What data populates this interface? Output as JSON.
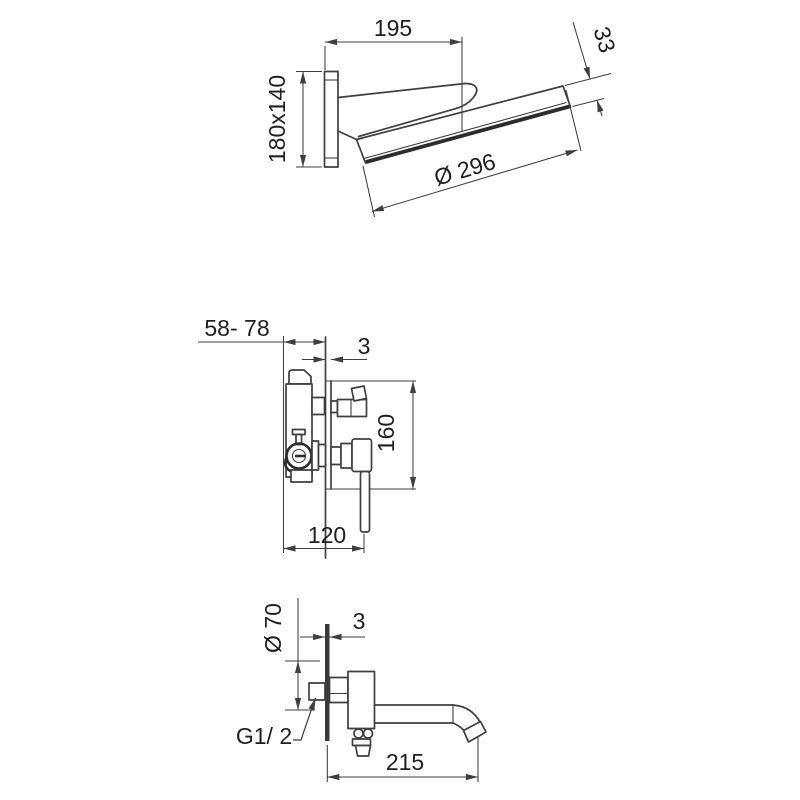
{
  "page": {
    "background": "#ffffff",
    "line_color": "#3f3f3f",
    "text_color": "#1f1f1f"
  },
  "views": {
    "showerhead": {
      "projection_length": "195",
      "head_edge_height": "33",
      "wall_plate_size": "180x140",
      "head_diameter": "Ø 296"
    },
    "mixer": {
      "install_depth_range": "58- 78",
      "finished_wall_offset": "3",
      "trim_plate_height": "160",
      "body_depth": "120"
    },
    "spout": {
      "escutcheon_diameter": "Ø 70",
      "finished_wall_offset": "3",
      "thread_size": "G1/ 2",
      "spout_length": "215"
    }
  }
}
